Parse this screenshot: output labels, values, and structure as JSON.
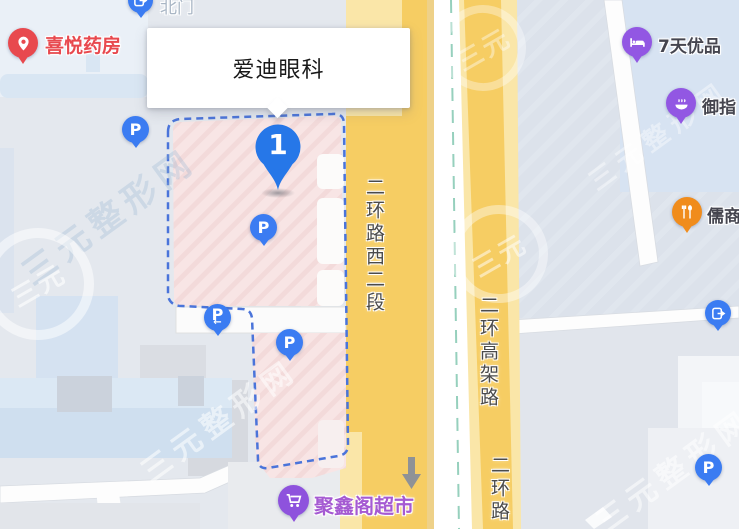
{
  "popup": {
    "title": "爱迪眼科"
  },
  "marker": {
    "number": "1"
  },
  "roads": [
    {
      "label": "二环路西二段"
    },
    {
      "label": "二环高架路"
    },
    {
      "label": "二环路"
    }
  ],
  "pois": [
    {
      "name": "北门",
      "kind": "gate"
    },
    {
      "name": "喜悦药房",
      "kind": "pharmacy"
    },
    {
      "name": "7天优品",
      "kind": "hotel"
    },
    {
      "name": "御指",
      "kind": "foot-massage"
    },
    {
      "name": "儒商",
      "kind": "restaurant"
    },
    {
      "name": "聚鑫阁超市",
      "kind": "supermarket"
    }
  ],
  "parking": {
    "label": "P",
    "entrance_arrow": "←"
  },
  "watermark": {
    "text": "三元整形网",
    "seal": "三元"
  },
  "colors": {
    "road_yellow": "#f6cd63",
    "road_yellow_pale": "#fae6a8",
    "median_teal": "#96d0bd",
    "highlight_pink": "#f8e5e5",
    "boundary_blue": "#4a74da",
    "parking_blue": "#3b7cf2",
    "marker_blue": "#2677e8",
    "pharmacy_red": "#e8494e",
    "hotel_purple": "#9257e3",
    "restaurant_orange": "#f08c1c",
    "supermarket_purple": "#a55ad2",
    "poi_text": "#45454f",
    "road_text": "#4b4b4b"
  }
}
